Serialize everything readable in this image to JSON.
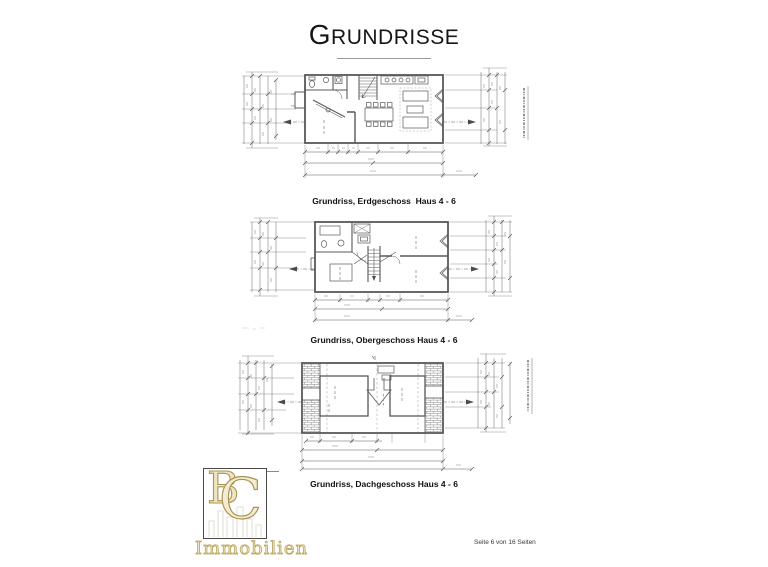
{
  "header": {
    "title_initial": "G",
    "title_rest": "RUNDRISSE"
  },
  "plans": [
    {
      "caption": "Grundriss, Erdgeschoss  Haus 4 - 6"
    },
    {
      "caption": "Grundriss, Obergeschoss Haus 4 - 6"
    },
    {
      "caption": "Grundriss, Dachgeschoss Haus 4 - 6"
    }
  ],
  "logo": {
    "monogram_b": "B",
    "monogram_c": "C",
    "name": "Immobilien"
  },
  "footer": {
    "page_label": "Seite 6 von 16 Seiten"
  },
  "colors": {
    "ink": "#4a4a4a",
    "logo_gold": "#b7a258"
  }
}
